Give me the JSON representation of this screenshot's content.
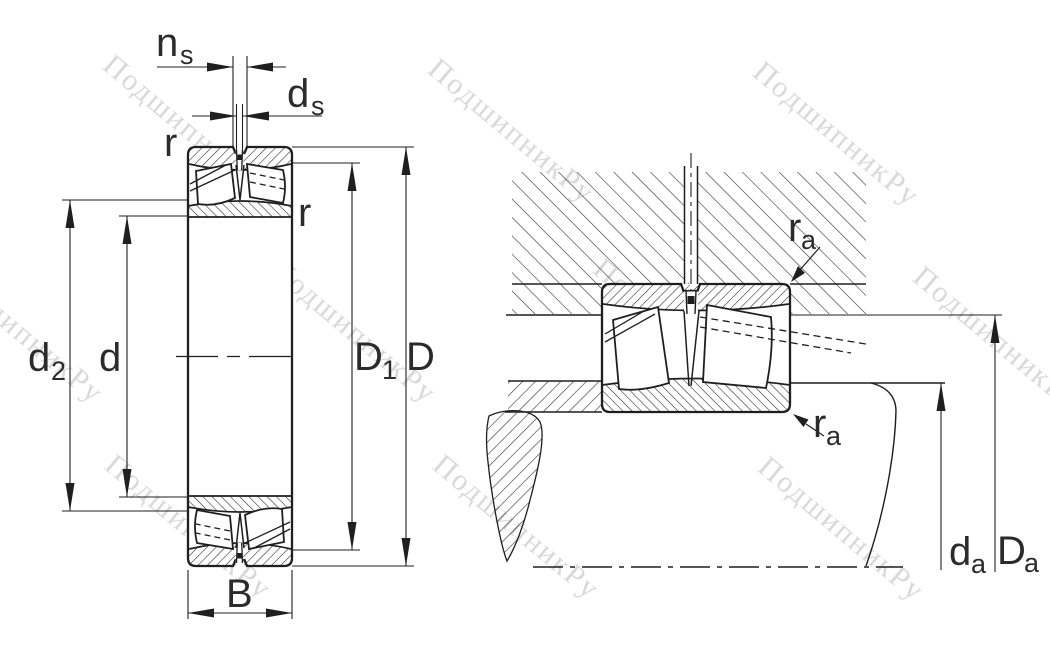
{
  "watermark": {
    "text": "ПодшипникРу",
    "color": "#d9d9d9"
  },
  "drawing": {
    "line_color": "#1f1f1f",
    "label_color": "#2b2b2b",
    "description": "spherical roller bearing cross-section and mounting drawing"
  },
  "left_view": {
    "labels": {
      "ns": {
        "main": "n",
        "sub": "s"
      },
      "ds": {
        "main": "d",
        "sub": "s"
      },
      "r_top": "r",
      "r_side": "r",
      "d2": {
        "main": "d",
        "sub": "2"
      },
      "d": "d",
      "D1": {
        "main": "D",
        "sub": "1"
      },
      "D": "D",
      "B": "B"
    }
  },
  "right_view": {
    "labels": {
      "ra_top": {
        "main": "r",
        "sub": "a"
      },
      "ra_bottom": {
        "main": "r",
        "sub": "a"
      },
      "da": {
        "main": "d",
        "sub": "a"
      },
      "Da": {
        "main": "D",
        "sub": "a"
      }
    }
  }
}
